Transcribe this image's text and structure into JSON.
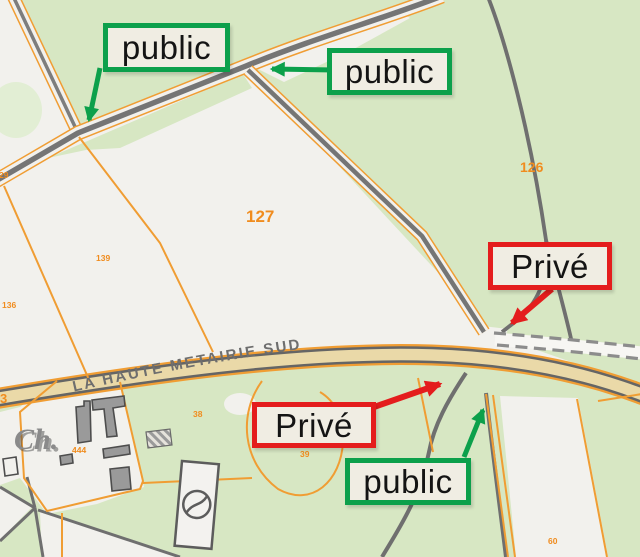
{
  "annotations": {
    "public_top_left": {
      "label": "public"
    },
    "public_top_right": {
      "label": "public"
    },
    "prive_right": {
      "label": "Privé"
    },
    "prive_bottom": {
      "label": "Privé"
    },
    "public_bottom": {
      "label": "public"
    }
  },
  "map": {
    "road_name": "LA HAUTE METAIRIE SUD",
    "road_number": "3",
    "place_abbreviation": "Ch.",
    "parcels": {
      "p127": "127",
      "p126": "126",
      "p139": "139",
      "p136": "136",
      "p29": "29",
      "p444": "444",
      "p38": "38",
      "p39": "39",
      "p60": "60"
    }
  },
  "colors": {
    "public_green": "#0ca04b",
    "prive_red": "#e41d1d",
    "annotation_bg": "#f0ede3",
    "annotation_text": "#141414",
    "parcel_orange": "#f08c1e",
    "boundary_orange": "#f09d33",
    "road_fill": "#ead9a8",
    "road_casing": "#656565",
    "path_gray": "#6f6f6f",
    "vegetation_green": "#d7e7c3",
    "parcel_white": "#f2f1ed"
  }
}
